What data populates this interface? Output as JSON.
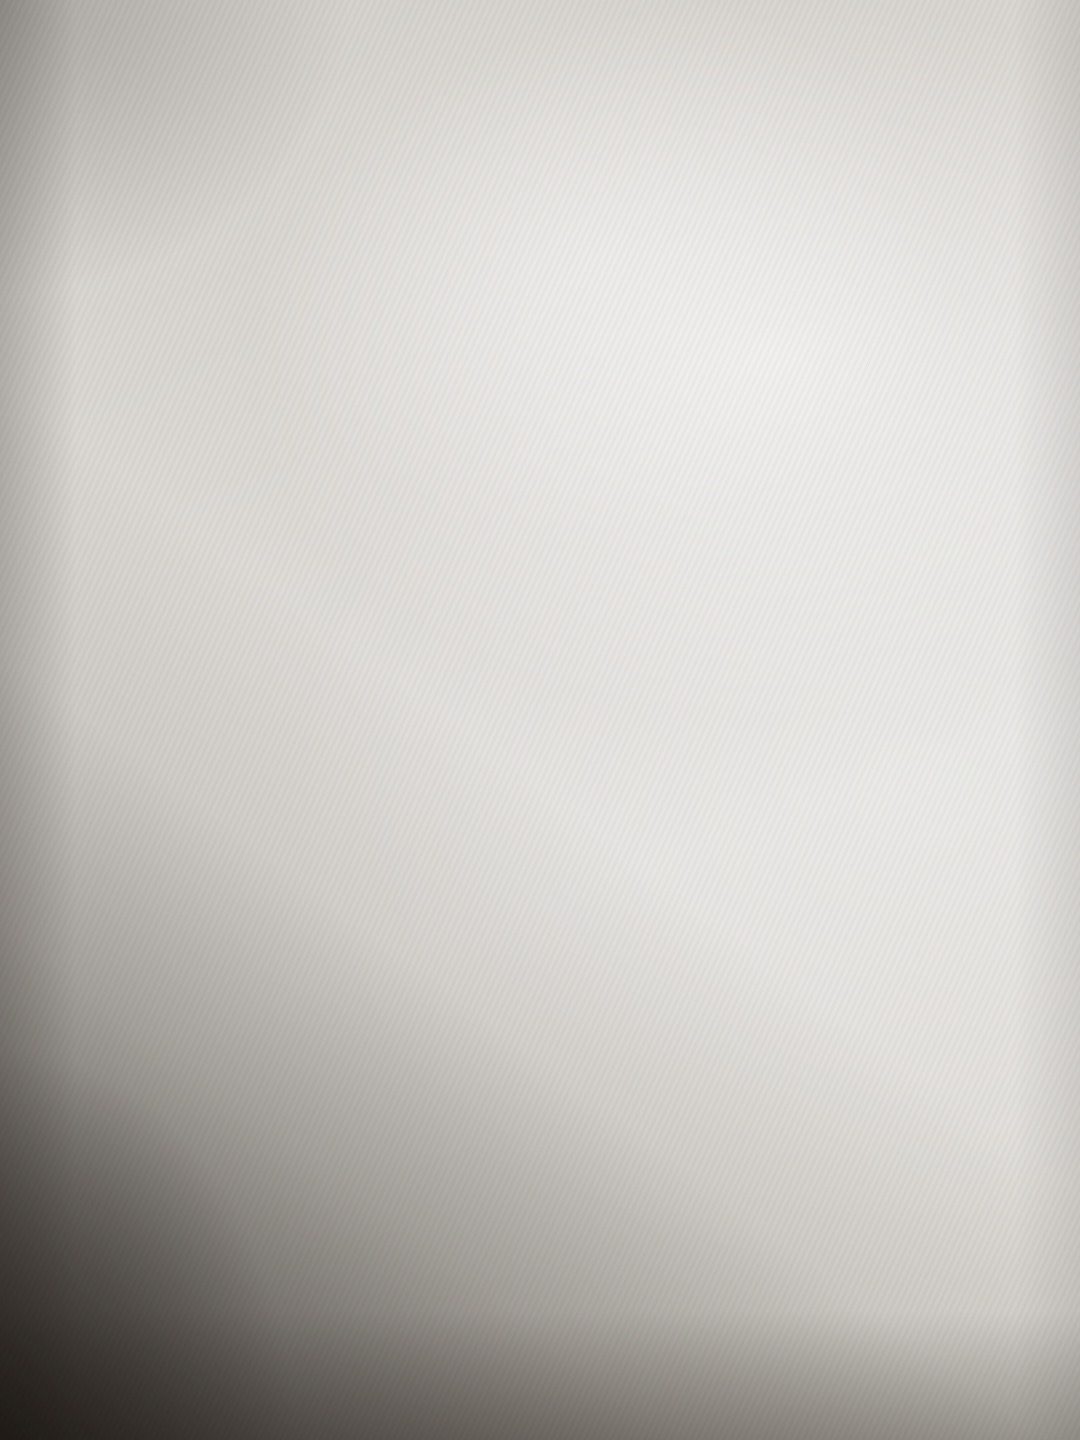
{
  "title": "1 этаж",
  "rooms": {
    "room10": {
      "number": "10",
      "area": "8.1"
    },
    "room1": {
      "number": "1",
      "area": "17.3"
    },
    "room2": {
      "number": "2",
      "area": "9.4"
    },
    "room8": {
      "number": "8",
      "area": "8.8"
    },
    "room3": {
      "number": "3",
      "area": "18.9"
    }
  },
  "door_labels": {
    "d9": "9",
    "d7": "7",
    "wc": "5",
    "corridor": "6",
    "bath": "4"
  },
  "annotations": {
    "red_number": "73",
    "height_note": "h = 2.55"
  },
  "dimensions": {
    "room1_top": "3.75",
    "room1_right": "4.60",
    "room2_top": "2.77",
    "room2_right": "3.40",
    "wc_bottom": "2.77",
    "passage_wall": "0.90",
    "room3_left_outer": "5.70",
    "room3_left_inner": "5.63",
    "room3_left": "3.85",
    "room3_right": "3.85",
    "porch_left": "1.90",
    "stairwell": "2.75"
  },
  "colors": {
    "line": "#322f29",
    "pencil": "#3c362e",
    "ink_blue": "#2d3da4",
    "ink_violet": "#5b3fae",
    "ink_purple": "#9550c6",
    "ink_magenta": "#a14fc0",
    "ink_red": "#c93350",
    "wall_fill": "#e6d6bd"
  }
}
